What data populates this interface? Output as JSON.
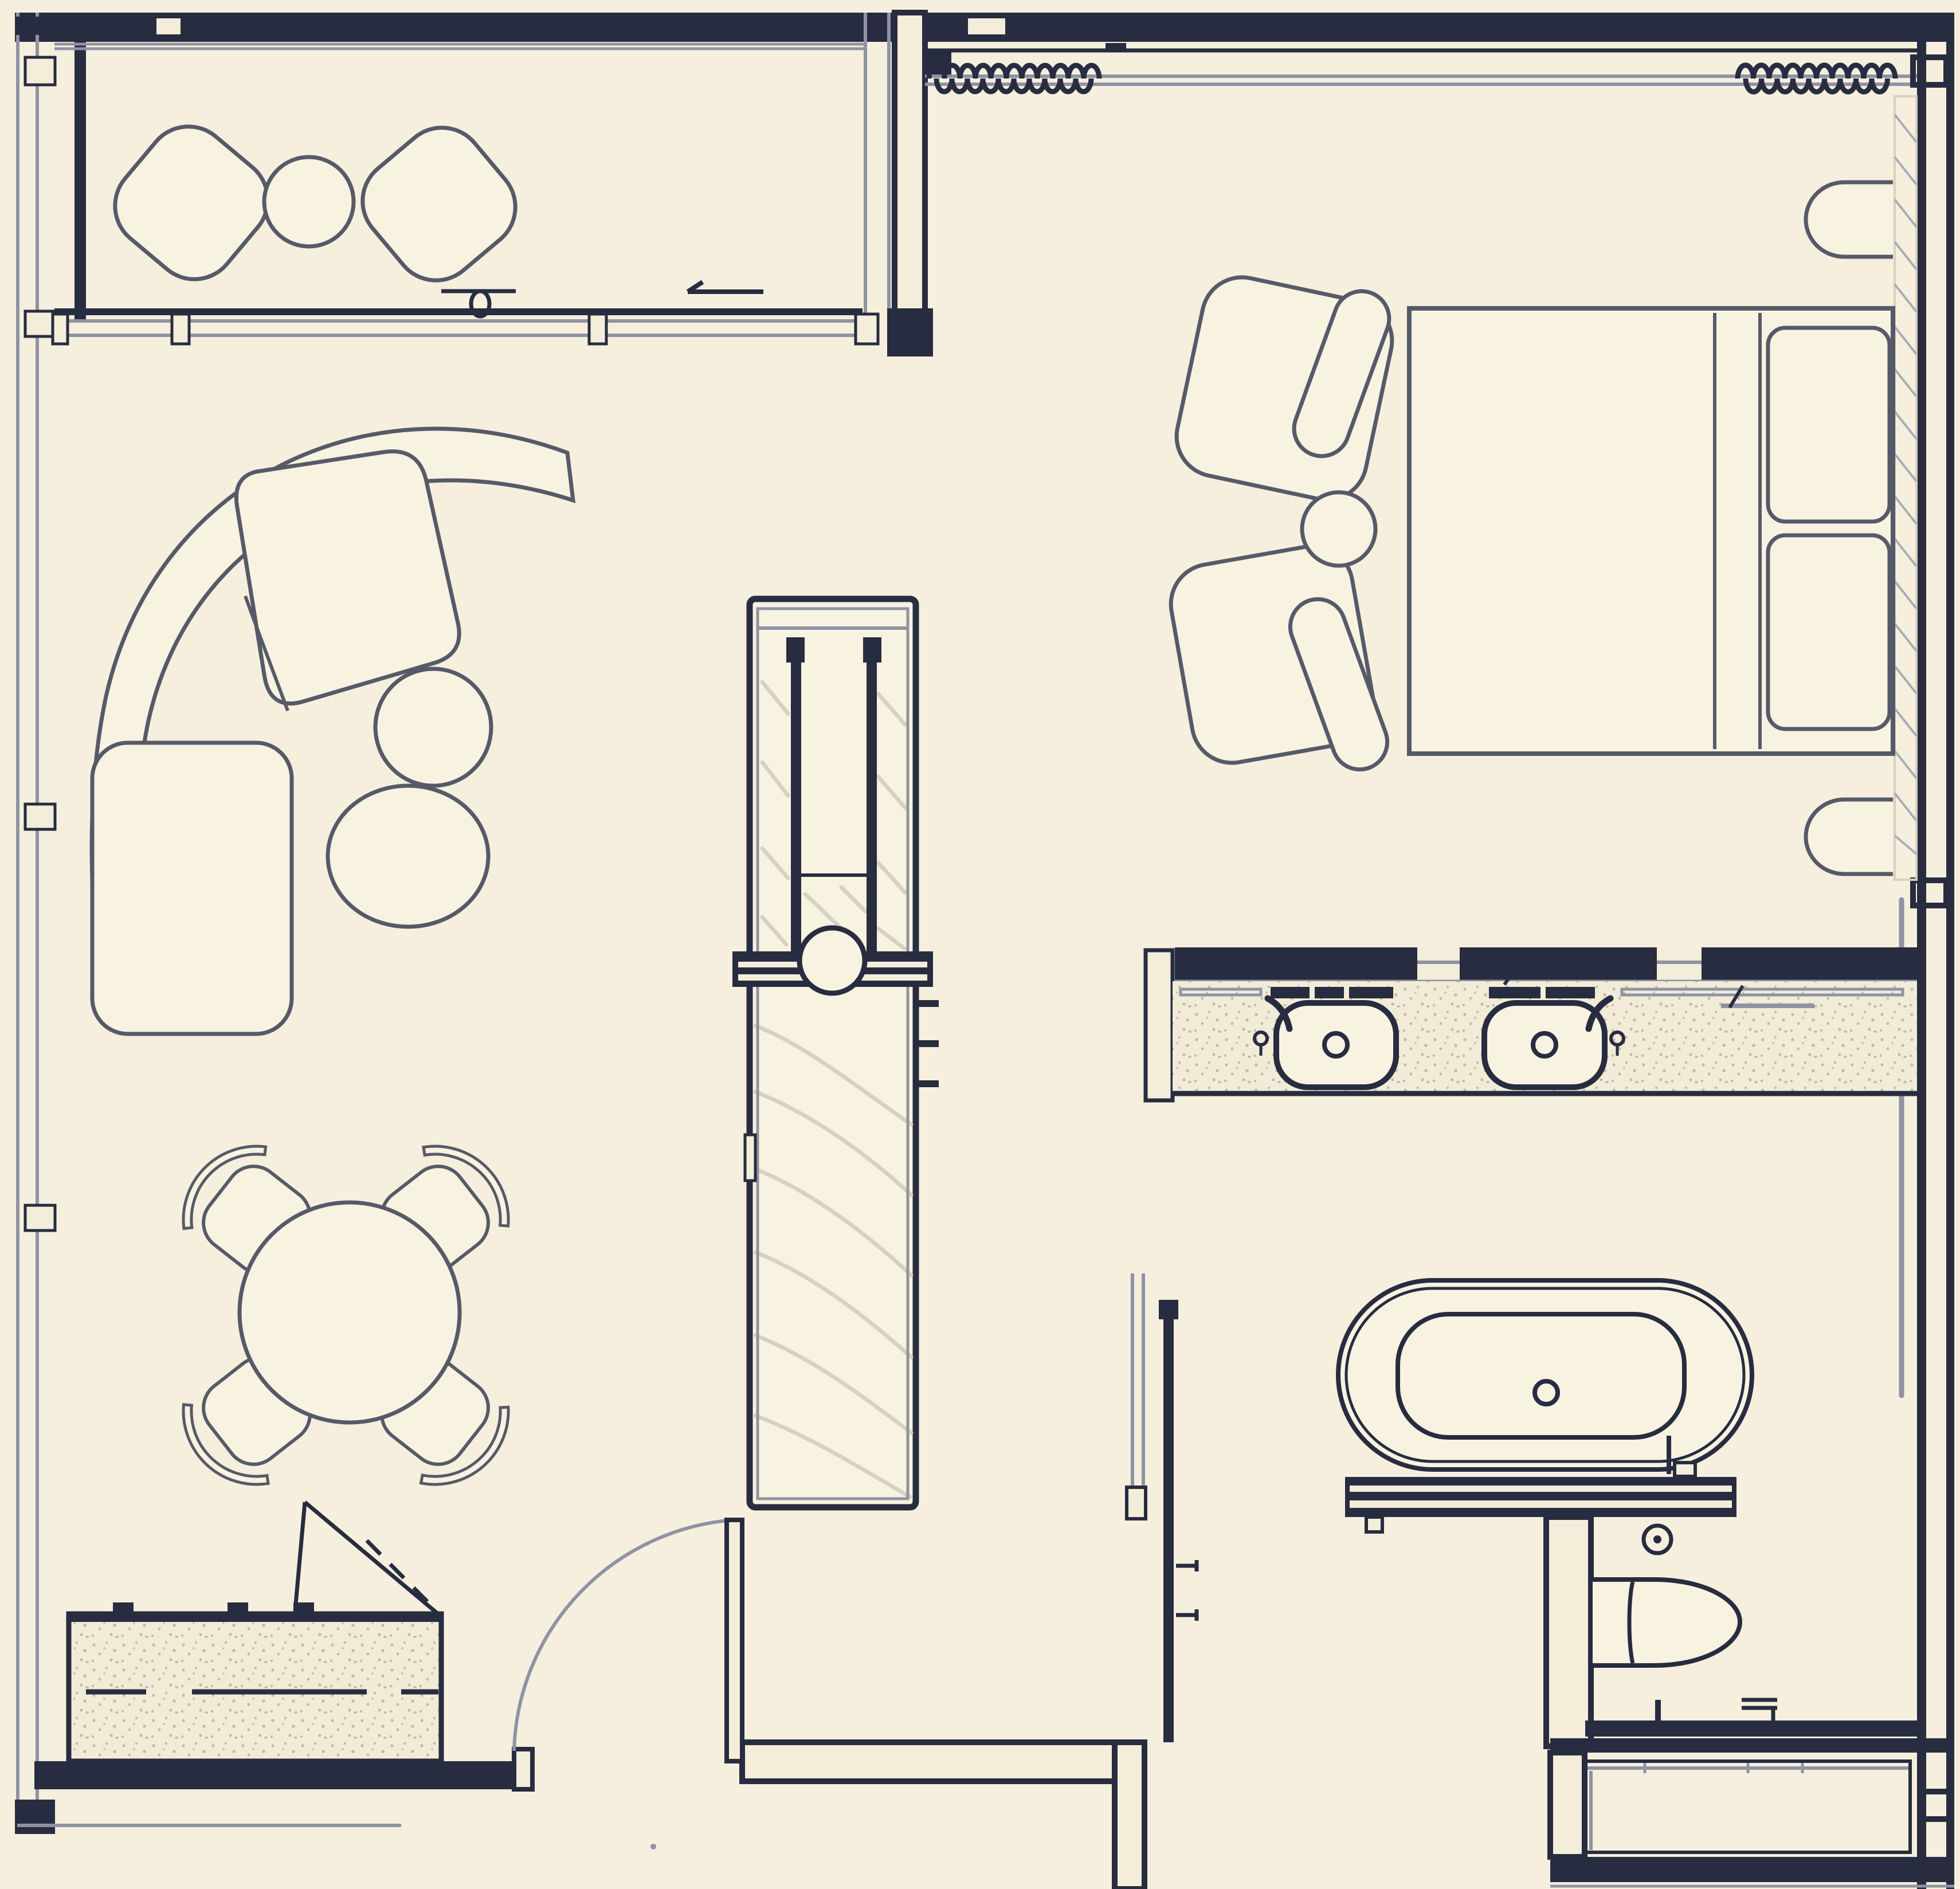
{
  "title": "apartment-suite-floor-plan",
  "palette": {
    "bg": "#f6efdd",
    "paper": "#f8f2e1",
    "ink": "#272c40",
    "ink-soft": "#565a68",
    "line-gray": "#8f93a3",
    "light-fill": "#f3edda",
    "grain": "#d8d1bf",
    "stipple-bg": "#f1ebd8",
    "stipple-dot": "#c3bba6",
    "hatch": "#a9adb9"
  },
  "plan": {
    "type": "floor-plan-line-drawing",
    "rooms": [
      {
        "name": "balcony",
        "furniture": [
          "lounge-chair",
          "round-side-table",
          "lounge-chair"
        ],
        "features": [
          "curtain-wall",
          "sliding-glass-door",
          "door-handle",
          "slide-direction-arrow"
        ]
      },
      {
        "name": "living-room",
        "furniture": [
          "curved-sectional-sofa",
          "nesting-coffee-table-small",
          "nesting-coffee-table-large"
        ]
      },
      {
        "name": "dining-area",
        "furniture": [
          "round-dining-table",
          "dining-chair-nw",
          "dining-chair-ne",
          "dining-chair-sw",
          "dining-chair-se"
        ]
      },
      {
        "name": "kitchen",
        "furniture": [
          "kitchen-counter-with-hob-knobs"
        ],
        "features": [
          "pivot-door-swing-triangle"
        ]
      },
      {
        "name": "entry",
        "features": [
          "entry-door-leaf",
          "door-swing-arc"
        ]
      },
      {
        "name": "hallway",
        "furniture": [
          "wardrobe-media-column-with-basin-circle"
        ],
        "features": [
          "wall-hooks"
        ]
      },
      {
        "name": "bedroom",
        "furniture": [
          "double-bed",
          "pillow",
          "pillow",
          "nightstand-top",
          "nightstand-bottom",
          "armchair-top",
          "armchair-bottom",
          "round-side-table"
        ],
        "features": [
          "curtain-coil-left",
          "curtain-coil-right",
          "window-bench-hatch"
        ]
      },
      {
        "name": "bathroom",
        "furniture": [
          "double-vanity-counter",
          "vessel-basin-left",
          "vessel-basin-right",
          "freestanding-bathtub",
          "bath-deck-bench"
        ],
        "features": [
          "mirror-shelf-bars",
          "faucet-levers",
          "tub-filler",
          "floor-drain"
        ]
      },
      {
        "name": "wc",
        "furniture": [
          "wall-hung-toilet"
        ],
        "features": [
          "toilet-brush-tick",
          "paper-holder",
          "floor-drain"
        ]
      },
      {
        "name": "closet-room",
        "furniture": [
          "built-in-wardrobe-with-rail"
        ]
      }
    ]
  }
}
